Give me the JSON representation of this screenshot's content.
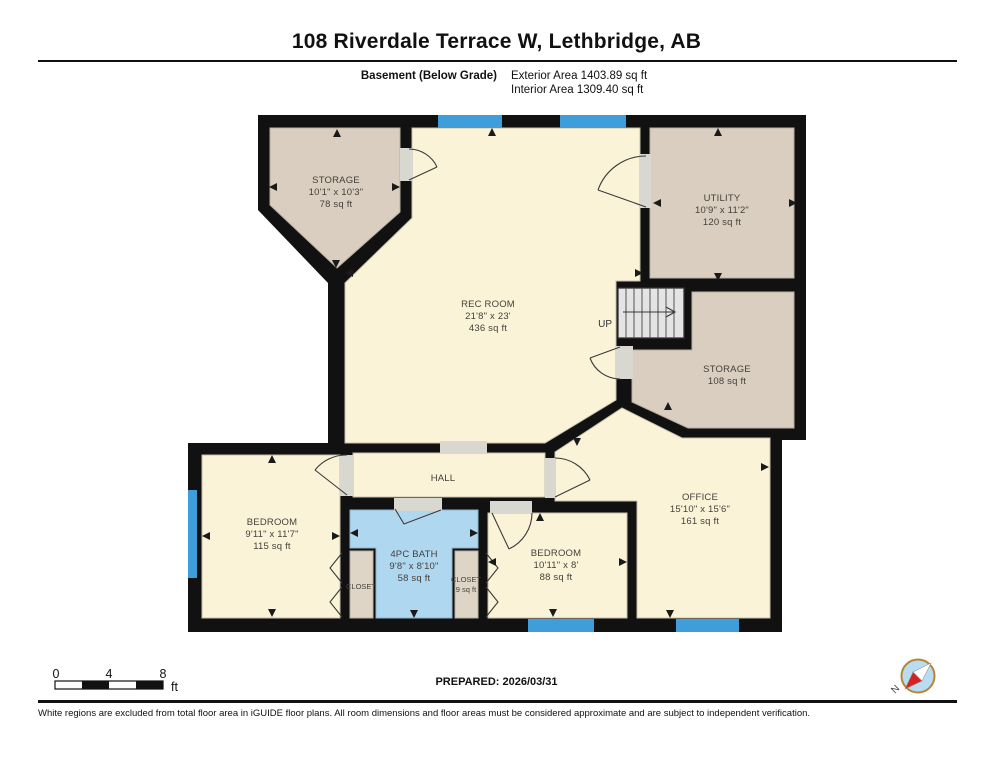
{
  "header": {
    "title": "108 Riverdale Terrace W, Lethbridge, AB",
    "floor_label": "Basement (Below Grade)",
    "exterior_area": "Exterior Area 1403.89 sq ft",
    "interior_area": "Interior Area 1309.40 sq ft"
  },
  "rooms": {
    "storage_top": {
      "name": "STORAGE",
      "dims": "10'1\" x 10'3\"",
      "area": "78 sq ft"
    },
    "rec_room": {
      "name": "REC ROOM",
      "dims": "21'8\" x 23'",
      "area": "436 sq ft"
    },
    "utility": {
      "name": "UTILITY",
      "dims": "10'9\" x 11'2\"",
      "area": "120 sq ft"
    },
    "storage_right": {
      "name": "STORAGE",
      "area": "108 sq ft"
    },
    "stairs": {
      "label": "UP"
    },
    "hall": {
      "name": "HALL"
    },
    "bedroom_left": {
      "name": "BEDROOM",
      "dims": "9'11\" x 11'7\"",
      "area": "115 sq ft"
    },
    "bath": {
      "name": "4PC BATH",
      "dims": "9'8\" x 8'10\"",
      "area": "58 sq ft"
    },
    "closet_left": {
      "name": "CLOSET"
    },
    "closet_right": {
      "name": "CLOSET",
      "area": "9 sq ft"
    },
    "bedroom_mid": {
      "name": "BEDROOM",
      "dims": "10'11\" x 8'",
      "area": "88 sq ft"
    },
    "office": {
      "name": "OFFICE",
      "dims": "15'10\" x 15'6\"",
      "area": "161 sq ft"
    }
  },
  "scale_bar": {
    "ticks": [
      "0",
      "4",
      "8"
    ],
    "unit": "ft"
  },
  "compass": {
    "label": "N"
  },
  "footer": {
    "prepared": "PREPARED: 2026/03/31",
    "disclaimer": "White regions are excluded from total floor area in iGUIDE floor plans. All room dimensions and floor areas must be considered approximate and are subject to independent verification."
  },
  "colors": {
    "wall": "#111111",
    "room_yellow": "#faf3d8",
    "room_tan": "#d9cec0",
    "closet_tan": "#ded5c7",
    "bath_blue": "#b0d7f0",
    "window_blue": "#3f9ed9",
    "stairs_gray": "#e4e4e4"
  }
}
